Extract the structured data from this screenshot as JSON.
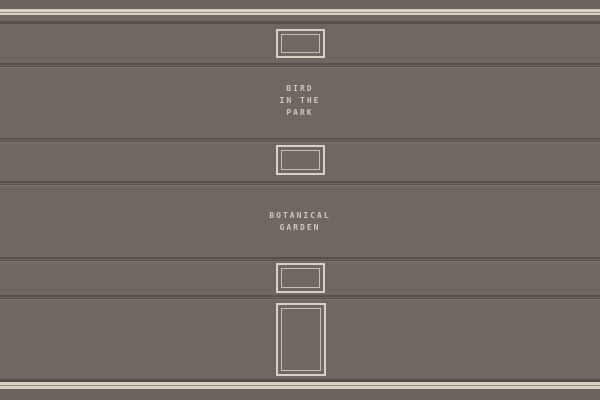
{
  "scene": {
    "name": "gallery wall with framed exhibits",
    "plaques": {
      "bird": {
        "line1": "BIRD",
        "line2": "IN THE",
        "line3": "PARK"
      },
      "garden": {
        "line1": "BOTANICAL",
        "line2": "GARDEN"
      }
    }
  },
  "colors": {
    "wall": "#6f6862",
    "wall_edge": "#6a635d",
    "trim_light": "#d7d0c3",
    "trim_mid": "#968e84",
    "trim_dark": "#564f49",
    "groove_dark": "#58514b",
    "groove_mid": "#6e6760",
    "groove_light": "#7b746d",
    "frame_outer": "#d7d0c3",
    "frame_inner": "#c5beb1",
    "label_text": "#cfc8ba"
  }
}
